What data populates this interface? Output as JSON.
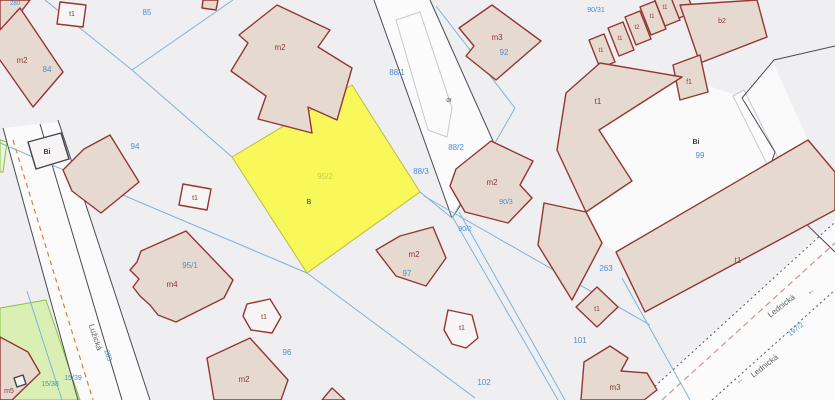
{
  "map": {
    "title": "cadastral-map-view",
    "w": 835,
    "h": 400,
    "palette": {
      "bg": "#efeef0",
      "road": "#fbfbfc",
      "parcelWhite": "#fafafb",
      "tan": "#e6d9d0",
      "whiteB": "#f6f4f5",
      "bStroke": "#943733",
      "darkStroke": "#44444c",
      "yellowFill": "#f8f85a",
      "yellowStroke": "#bcbc3e",
      "greenFill": "#d9efb4",
      "greenFill2": "#e9f5d8",
      "greenStroke": "#8ac342",
      "blueLine": "#7fb3da",
      "darkLine": "#4a4a54",
      "grayStroke": "#c8c8d0",
      "blue": "#4a8fd3",
      "red": "#8a3a34",
      "dark": "#3c3c44",
      "street": "#5f5f68",
      "yellowTxt": "#c2cc49",
      "teal": "#3f9f97",
      "orange": "#e0812f",
      "pink": "#d49090",
      "dot": "#55555e"
    },
    "underlay": [
      {
        "n": "road-luzicka-surface",
        "p": "3,128 58,122 150,400 78,400",
        "f": "road",
        "c": false
      },
      {
        "n": "road-top-surface",
        "p": "374,0 430,0 497,150 452,218",
        "f": "road",
        "c": false
      },
      {
        "n": "road-lednicka-surface",
        "p": "640,400 835,220 835,400",
        "f": "road",
        "c": false
      },
      {
        "n": "parcel-99",
        "p": "683,77 599,130 632,181 586,212 602,243 616,252 808,140 772,60 741,97",
        "f": "parcelWhite",
        "c": true
      },
      {
        "n": "parcel-15-39-green",
        "p": "0,308 46,300 80,400 0,400",
        "f": "greenFill",
        "s": "greenStroke",
        "sw": 1,
        "c": true
      },
      {
        "n": "parcel-green-sliver",
        "p": "0,140 7,142 3,172 0,172",
        "f": "greenFill2",
        "s": "greenStroke",
        "sw": 1,
        "c": true
      },
      {
        "n": "parcel-95-2-highlight",
        "p": "352,85 420,192 307,273 232,157",
        "f": "yellowFill",
        "s": "yellowStroke",
        "sw": 1,
        "c": true
      },
      {
        "n": "footpath-top-road",
        "p": "396,20 420,12 452,108 447,137 428,130",
        "f": "road",
        "s": "grayStroke",
        "sw": 1,
        "c": false
      },
      {
        "n": "footpath-right-strip",
        "p": "733,96 744,90 802,206 791,212",
        "f": "road",
        "s": "grayStroke",
        "sw": 1,
        "c": false
      }
    ],
    "lines": [
      {
        "n": "road-edge-left-1",
        "p": "3,128 78,400",
        "s": "darkLine"
      },
      {
        "n": "road-edge-left-2",
        "p": "40,124 122,400",
        "s": "darkLine"
      },
      {
        "n": "road-edge-left-3",
        "p": "58,120 150,400",
        "s": "darkLine"
      },
      {
        "n": "road-marking-orange",
        "p": "13,140 93,400",
        "s": "orange",
        "sw": 1.2,
        "d": "5,4"
      },
      {
        "n": "road-edge-top-1",
        "p": "374,0 452,218",
        "s": "darkLine"
      },
      {
        "n": "road-edge-top-2",
        "p": "430,0 497,150",
        "s": "darkLine"
      },
      {
        "n": "road-edge-top-3",
        "p": "497,150 452,218",
        "s": "darkLine"
      },
      {
        "n": "boundary-dark-right",
        "p": "835,46 774,60 742,98 775,152 760,196 798,216 835,252",
        "s": "darkLine"
      },
      {
        "n": "boundary-blue-1",
        "p": "45,0 132,70",
        "s": "blueLine"
      },
      {
        "n": "boundary-blue-2",
        "p": "233,0 132,70",
        "s": "blueLine"
      },
      {
        "n": "boundary-blue-3",
        "p": "132,70 232,157",
        "s": "blueLine"
      },
      {
        "n": "boundary-blue-4",
        "p": "0,143 307,273",
        "s": "blueLine"
      },
      {
        "n": "boundary-blue-5",
        "p": "307,273 475,398",
        "s": "blueLine"
      },
      {
        "n": "boundary-blue-6",
        "p": "436,6 515,108 452,218",
        "s": "blueLine"
      },
      {
        "n": "boundary-blue-7",
        "p": "420,192 452,218",
        "s": "blueLine"
      },
      {
        "n": "boundary-blue-8",
        "p": "424,196 650,325",
        "s": "blueLine"
      },
      {
        "n": "boundary-blue-9",
        "p": "452,216 558,400",
        "s": "blueLine"
      },
      {
        "n": "boundary-blue-10",
        "p": "459,212 565,400",
        "s": "blueLine"
      },
      {
        "n": "boundary-blue-11",
        "p": "622,278 690,400",
        "s": "blueLine"
      },
      {
        "n": "boundary-blue-12",
        "p": "27,291 62,400",
        "s": "blueLine"
      },
      {
        "n": "road-dotted-1",
        "p": "640,400 835,222",
        "s": "dot",
        "d": "2,3"
      },
      {
        "n": "road-dotted-2",
        "p": "712,400 835,290",
        "s": "dot",
        "d": "2,3"
      },
      {
        "n": "road-dashed-pink",
        "p": "662,400 835,243",
        "s": "pink",
        "sw": 1.2,
        "d": "6,4"
      }
    ],
    "buildings": [
      {
        "n": "building-corner-tl",
        "p": "0,0 30,0 10,26 0,30",
        "f": "tan"
      },
      {
        "n": "building-m2-84",
        "p": "20,8 63,72 33,107 -12,43",
        "f": "tan"
      },
      {
        "n": "building-t1-85",
        "p": "60,2 86,5 83,27 57,24",
        "f": "whiteB"
      },
      {
        "n": "building-top-edge-cut",
        "p": "203,0 218,0 216,10 202,8",
        "f": "tan"
      },
      {
        "n": "building-m2-88",
        "p": "277,5 330,30 318,47 352,68 337,120 308,107 312,133 258,119 266,96 231,71 248,43 239,35",
        "f": "tan"
      },
      {
        "n": "building-m3-92",
        "p": "459,28 492,5 541,41 496,80 466,56 474,46",
        "f": "tan"
      },
      {
        "n": "building-t1-row-1",
        "p": "604,34 615,62 600,68 589,40",
        "f": "tan"
      },
      {
        "n": "building-t1-row-2",
        "p": "623,22 634,50 619,56 608,28",
        "f": "tan"
      },
      {
        "n": "building-t2-row",
        "p": "640,11 651,39 636,45 625,17",
        "f": "tan"
      },
      {
        "n": "building-t1-row-3",
        "p": "655,1 666,29 651,35 640,7",
        "f": "tan"
      },
      {
        "n": "building-t1-row-4",
        "p": "669,-8 680,20 665,26 654,-2",
        "f": "tan"
      },
      {
        "n": "building-row-cut",
        "p": "683,-16 694,12 679,18 668,-10",
        "f": "tan"
      },
      {
        "n": "building-b2",
        "p": "680,5 757,0 767,37 700,63",
        "f": "tan"
      },
      {
        "n": "building-f1",
        "p": "673,65 700,55 708,92 680,100",
        "f": "tan"
      },
      {
        "n": "building-t1-right-upper",
        "p": "566,93 600,63 682,77 599,130 632,181 586,212 557,150",
        "f": "tan"
      },
      {
        "n": "building-t1-right-lower",
        "p": "544,203 586,212 602,243 572,300 538,245",
        "f": "tan"
      },
      {
        "n": "building-t1-band",
        "p": "616,252 808,140 835,172 835,210 645,312",
        "f": "tan"
      },
      {
        "n": "building-bi-white",
        "p": "28,142 61,133 69,159 36,169",
        "f": "whiteB",
        "s2": "darkStroke"
      },
      {
        "n": "building-m2-94",
        "p": "110,135 139,182 101,213 72,191 63,170 84,149",
        "f": "tan"
      },
      {
        "n": "building-t1-94",
        "p": "183,184 211,189 207,210 179,205",
        "f": "whiteB"
      },
      {
        "n": "building-m4",
        "p": "141,251 186,231 233,280 224,298 176,322 158,315 150,305 140,296 133,287 139,279 130,270 137,262",
        "f": "tan"
      },
      {
        "n": "building-m2-90",
        "p": "456,169 491,141 533,161 520,185 532,198 508,223 465,212 450,186",
        "f": "tan"
      },
      {
        "n": "building-m2-97",
        "p": "400,236 433,227 446,258 426,286 396,276 376,250",
        "f": "tan"
      },
      {
        "n": "building-t1-96",
        "p": "247,304 270,299 281,317 272,333 251,330 243,316",
        "f": "whiteB"
      },
      {
        "n": "building-m2-96",
        "p": "207,358 250,338 288,380 281,400 214,400",
        "f": "tan"
      },
      {
        "n": "building-t1-102",
        "p": "448,310 472,315 478,338 466,348 452,344 444,330",
        "f": "whiteB"
      },
      {
        "n": "building-t1-101",
        "p": "597,287 618,307 597,327 576,307",
        "f": "tan"
      },
      {
        "n": "building-m3-101",
        "p": "584,362 610,346 628,358 621,371 647,373 657,390 644,400 581,400",
        "f": "tan"
      },
      {
        "n": "building-m5",
        "p": "0,337 28,352 40,373 12,400 0,400",
        "f": "tan"
      },
      {
        "n": "building-bottom-cut",
        "p": "322,400 332,388 345,400",
        "f": "tan"
      },
      {
        "n": "shed-symbol",
        "p": "14,378 23,375 26,384 17,387",
        "f": "whiteB",
        "s2": "darkStroke"
      }
    ],
    "labels": [
      {
        "n": "parcel-no-280",
        "t": "280",
        "x": 15,
        "y": 5,
        "c": "blue",
        "s": 6,
        "k": true
      },
      {
        "n": "parcel-no-85",
        "t": "85",
        "x": 147,
        "y": 15,
        "c": "blue",
        "s": 8,
        "k": true
      },
      {
        "n": "bldg-t1-85",
        "t": "t1",
        "x": 72,
        "y": 16,
        "c": "red",
        "s": 7
      },
      {
        "n": "bldg-m2-84",
        "t": "m2",
        "x": 22,
        "y": 63,
        "c": "red",
        "s": 8
      },
      {
        "n": "parcel-no-84",
        "t": "84",
        "x": 47,
        "y": 72,
        "c": "blue",
        "s": 8,
        "k": true
      },
      {
        "n": "bldg-m2-88",
        "t": "m2",
        "x": 280,
        "y": 50,
        "c": "red",
        "s": 8
      },
      {
        "n": "parcel-no-88-1",
        "t": "88/1",
        "x": 397,
        "y": 75,
        "c": "blue",
        "s": 8,
        "k": true
      },
      {
        "n": "bldg-m3-92",
        "t": "m3",
        "x": 497,
        "y": 40,
        "c": "red",
        "s": 8
      },
      {
        "n": "parcel-no-92",
        "t": "92",
        "x": 504,
        "y": 55,
        "c": "blue",
        "s": 8,
        "k": true
      },
      {
        "n": "parcel-no-90-31",
        "t": "90/31",
        "x": 596,
        "y": 12,
        "c": "blue",
        "s": 7,
        "k": true
      },
      {
        "n": "bldg-t1-row-1",
        "t": "t1",
        "x": 601,
        "y": 52,
        "c": "red",
        "s": 6
      },
      {
        "n": "bldg-t1-row-2",
        "t": "t1",
        "x": 620,
        "y": 40,
        "c": "red",
        "s": 6
      },
      {
        "n": "bldg-t2-row",
        "t": "t2",
        "x": 637,
        "y": 29,
        "c": "red",
        "s": 6
      },
      {
        "n": "bldg-t1-row-3",
        "t": "t1",
        "x": 652,
        "y": 18,
        "c": "red",
        "s": 6
      },
      {
        "n": "bldg-t1-row-4",
        "t": "t1",
        "x": 665,
        "y": 9,
        "c": "red",
        "s": 6
      },
      {
        "n": "bldg-b2",
        "t": "b2",
        "x": 722,
        "y": 23,
        "c": "red",
        "s": 7
      },
      {
        "n": "bldg-f1",
        "t": "f1",
        "x": 689,
        "y": 84,
        "c": "red",
        "s": 7
      },
      {
        "n": "bldg-t1-right",
        "t": "t1",
        "x": 598,
        "y": 104,
        "c": "red",
        "s": 8
      },
      {
        "n": "landuse-bi-99",
        "t": "Bi",
        "x": 696,
        "y": 144,
        "c": "dark",
        "s": 7,
        "b": true
      },
      {
        "n": "parcel-no-99",
        "t": "99",
        "x": 700,
        "y": 158,
        "c": "blue",
        "s": 8,
        "k": true
      },
      {
        "n": "landuse-bi-84",
        "t": "Bi",
        "x": 47,
        "y": 154,
        "c": "dark",
        "s": 7,
        "b": true
      },
      {
        "n": "parcel-no-94",
        "t": "94",
        "x": 135,
        "y": 149,
        "c": "blue",
        "s": 8,
        "k": true
      },
      {
        "n": "bldg-t1-94",
        "t": "t1",
        "x": 195,
        "y": 200,
        "c": "red",
        "s": 7
      },
      {
        "n": "parcel-no-95-2",
        "t": "95/2",
        "x": 325,
        "y": 179,
        "c": "yellowTxt",
        "s": 8,
        "k": true
      },
      {
        "n": "landuse-b-95-2",
        "t": "B",
        "x": 309,
        "y": 204,
        "c": "dark",
        "s": 7
      },
      {
        "n": "parcel-no-88-2",
        "t": "88/2",
        "x": 456,
        "y": 150,
        "c": "blue",
        "s": 8,
        "k": true
      },
      {
        "n": "parcel-no-88-3",
        "t": "88/3",
        "x": 421,
        "y": 174,
        "c": "blue",
        "s": 8,
        "k": true
      },
      {
        "n": "landuse-dr",
        "t": "dr",
        "x": 449,
        "y": 102,
        "c": "dark",
        "s": 6
      },
      {
        "n": "bldg-m2-90",
        "t": "m2",
        "x": 492,
        "y": 185,
        "c": "red",
        "s": 8
      },
      {
        "n": "parcel-no-90-3",
        "t": "90/3",
        "x": 506,
        "y": 204,
        "c": "blue",
        "s": 7,
        "k": true
      },
      {
        "n": "parcel-no-90-2",
        "t": "90/2",
        "x": 465,
        "y": 231,
        "c": "blue",
        "s": 7,
        "k": true
      },
      {
        "n": "parcel-no-95-1",
        "t": "95/1",
        "x": 190,
        "y": 268,
        "c": "blue",
        "s": 8,
        "k": true
      },
      {
        "n": "bldg-m4",
        "t": "m4",
        "x": 172,
        "y": 287,
        "c": "red",
        "s": 8
      },
      {
        "n": "bldg-t1-96",
        "t": "t1",
        "x": 264,
        "y": 319,
        "c": "red",
        "s": 7
      },
      {
        "n": "parcel-no-96",
        "t": "96",
        "x": 287,
        "y": 355,
        "c": "blue",
        "s": 8,
        "k": true
      },
      {
        "n": "bldg-m2-96",
        "t": "m2",
        "x": 244,
        "y": 382,
        "c": "red",
        "s": 8
      },
      {
        "n": "bldg-m2-97",
        "t": "m2",
        "x": 414,
        "y": 257,
        "c": "red",
        "s": 8
      },
      {
        "n": "parcel-no-97",
        "t": "97",
        "x": 407,
        "y": 276,
        "c": "blue",
        "s": 8,
        "k": true
      },
      {
        "n": "bldg-t1-102",
        "t": "t1",
        "x": 462,
        "y": 330,
        "c": "red",
        "s": 7
      },
      {
        "n": "parcel-no-102",
        "t": "102",
        "x": 484,
        "y": 385,
        "c": "blue",
        "s": 8,
        "k": true
      },
      {
        "n": "parcel-no-263",
        "t": "263",
        "x": 606,
        "y": 271,
        "c": "blue",
        "s": 8,
        "k": true
      },
      {
        "n": "bldg-t1-101",
        "t": "t1",
        "x": 597,
        "y": 311,
        "c": "red",
        "s": 7
      },
      {
        "n": "parcel-no-101",
        "t": "101",
        "x": 580,
        "y": 343,
        "c": "blue",
        "s": 8,
        "k": true
      },
      {
        "n": "bldg-m3-101",
        "t": "m3",
        "x": 615,
        "y": 390,
        "c": "red",
        "s": 8
      },
      {
        "n": "bldg-t1-band",
        "t": "t1",
        "x": 738,
        "y": 263,
        "c": "red",
        "s": 8
      },
      {
        "n": "bldg-m5",
        "t": "m5",
        "x": 9,
        "y": 393,
        "c": "red",
        "s": 7
      },
      {
        "n": "parcel-no-15-38",
        "t": "15/38",
        "x": 50,
        "y": 386,
        "c": "teal",
        "s": 7,
        "k": true
      },
      {
        "n": "parcel-no-15-39",
        "t": "15/39",
        "x": 73,
        "y": 380,
        "c": "blue",
        "s": 7,
        "k": true
      },
      {
        "n": "parcel-no-283",
        "t": "283",
        "x": 106,
        "y": 356,
        "c": "blue",
        "s": 7,
        "r": 72,
        "k": true
      },
      {
        "n": "street-luzicka",
        "t": "Lužická",
        "x": 93,
        "y": 338,
        "c": "street",
        "s": 8,
        "r": 72
      },
      {
        "n": "street-lednicka-1",
        "t": "Lednická",
        "x": 783,
        "y": 308,
        "c": "street",
        "s": 8,
        "r": -38
      },
      {
        "n": "street-arrow-1",
        "t": "←",
        "x": 812,
        "y": 293,
        "c": "street",
        "s": 8,
        "r": -38
      },
      {
        "n": "street-lednicka-2",
        "t": "Lednická",
        "x": 766,
        "y": 368,
        "c": "street",
        "s": 8,
        "r": -38
      },
      {
        "n": "street-arrow-2",
        "t": "←",
        "x": 741,
        "y": 382,
        "c": "street",
        "s": 8,
        "r": -38
      },
      {
        "n": "parcel-no-197-2",
        "t": "197/2",
        "x": 797,
        "y": 331,
        "c": "blue",
        "s": 7,
        "r": -38,
        "k": true
      }
    ]
  }
}
